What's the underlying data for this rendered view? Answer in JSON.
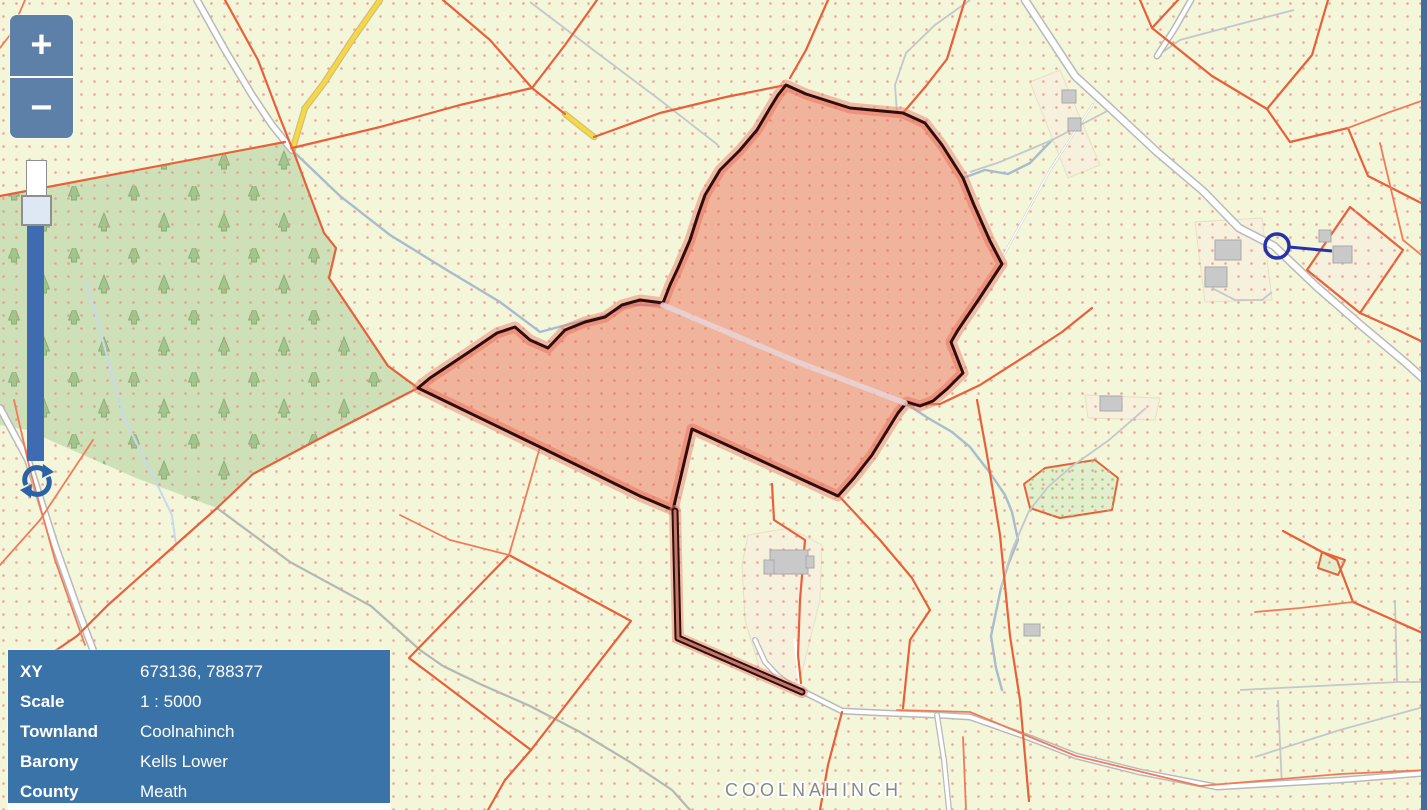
{
  "app": {
    "title": "Townland map viewer"
  },
  "zoom_controls": {
    "zoom_in_label": "+",
    "zoom_out_label": "−"
  },
  "info_panel": {
    "rows": [
      {
        "label": "XY",
        "value": "673136, 788377"
      },
      {
        "label": "Scale",
        "value": "1 : 5000"
      },
      {
        "label": "Townland",
        "value": "Coolnahinch"
      },
      {
        "label": "Barony",
        "value": "Kells Lower"
      },
      {
        "label": "County",
        "value": "Meath"
      }
    ]
  },
  "map": {
    "townland_label": "COOLNAHINCH"
  },
  "colors": {
    "bg": "#f3f6d9",
    "dot": "#ef8f88",
    "forest": "#cde0b8",
    "cream": "#f6f1dc",
    "red-line": "#e8603a",
    "red-line-light": "#ef7c58",
    "road-case": "#b9b9b9",
    "road-fill": "#ffffff",
    "yellow": "#f8d83e",
    "yellow-case": "#cdbf88",
    "stream": "#a9bccd",
    "track": "#b4b8b0",
    "band": "#e8d3d6",
    "sel-fill": "rgba(233,88,70,0.42)",
    "sel-border": "#2e0f0d",
    "sel-glow": "rgba(237,128,112,0.5)",
    "ui-blue": "#5c80a8",
    "slider-blue": "#3f6cb0",
    "panel-blue": "#3a73a8",
    "strip-blue": "#3d6fa3",
    "refresh-blue": "#2a62a8",
    "marker-navy": "#2632aa",
    "label-gray": "#858a84"
  }
}
